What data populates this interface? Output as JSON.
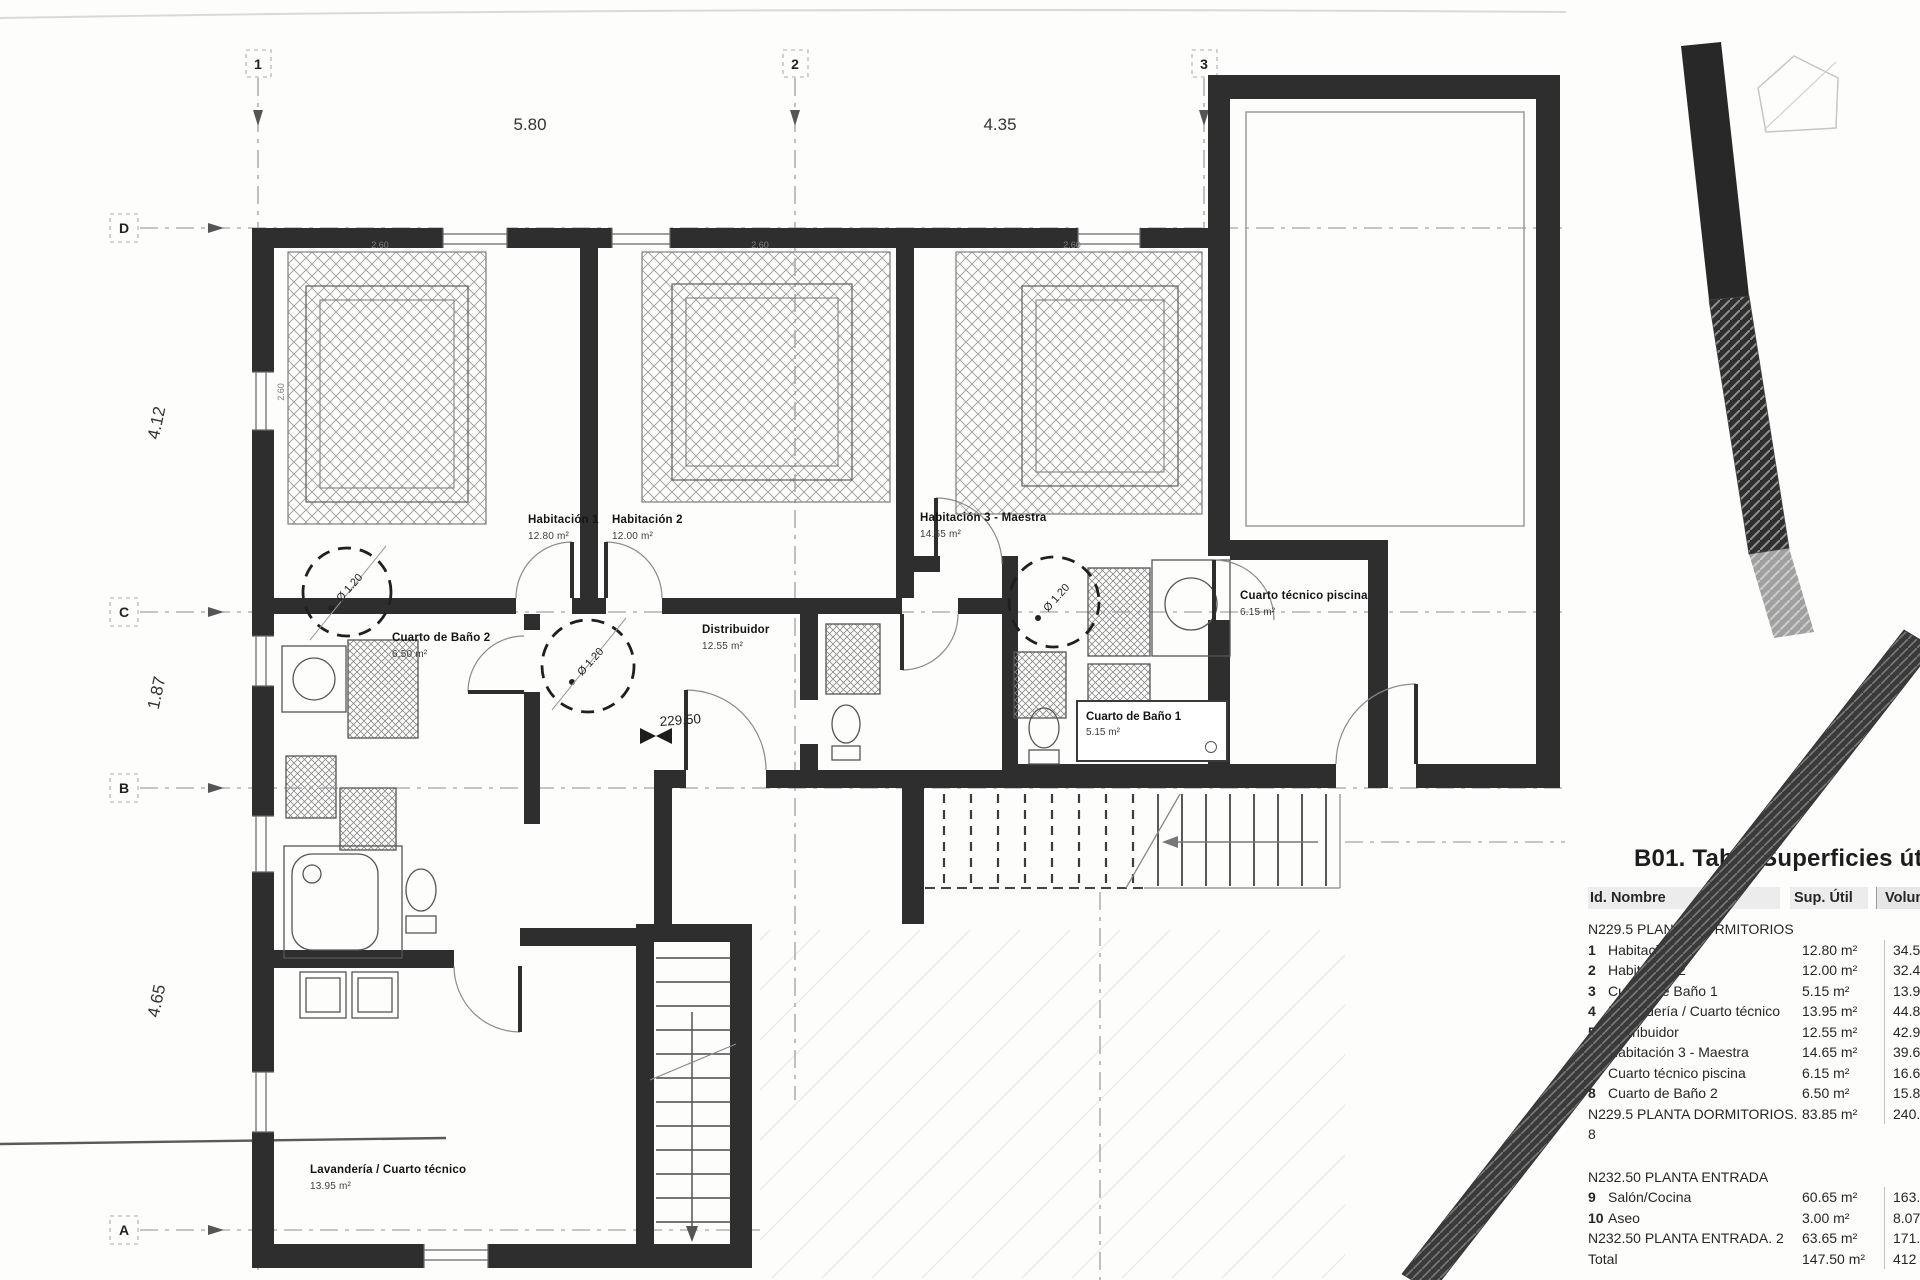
{
  "dimensions": {
    "top": [
      "5.80",
      "4.35"
    ],
    "left": [
      "4.12",
      "1.87",
      "4.65"
    ]
  },
  "grid": {
    "columns": [
      "1",
      "2",
      "3"
    ],
    "rows": [
      "D",
      "C",
      "B",
      "A"
    ]
  },
  "annotations": {
    "level": "229.50",
    "turning_circle": "Ø 1.20",
    "bed_dim": "2.60"
  },
  "rooms": {
    "hab1": {
      "name": "Habitación 1",
      "area": "12.80 m²"
    },
    "hab2": {
      "name": "Habitación 2",
      "area": "12.00 m²"
    },
    "hab3": {
      "name": "Habitación 3 - Maestra",
      "area": "14.65 m²"
    },
    "bano2": {
      "name": "Cuarto de Baño 2",
      "area": "6.50 m²"
    },
    "distribuidor": {
      "name": "Distribuidor",
      "area": "12.55 m²"
    },
    "piscina": {
      "name": "Cuarto técnico piscina",
      "area": "6.15 m²"
    },
    "bano1": {
      "name": "Cuarto de Baño 1",
      "area": "5.15 m²"
    },
    "lavanderia": {
      "name": "Lavandería / Cuarto técnico",
      "area": "13.95 m²"
    }
  },
  "table": {
    "title": "B01. Tabla Superficies útiles",
    "headers": {
      "id": "Id.",
      "nombre": "Nombre",
      "sup": "Sup. Útil",
      "vol": "Volumen"
    },
    "rows": [
      {
        "kind": "section",
        "name": "N229.5 PLANTA DORMITORIOS"
      },
      {
        "kind": "item",
        "id": "1",
        "name": "Habitación 1",
        "sup": "12.80 m²",
        "vol": "34.57 m³"
      },
      {
        "kind": "item",
        "id": "2",
        "name": "Habitación 2",
        "sup": "12.00 m²",
        "vol": "32.47 m³"
      },
      {
        "kind": "item",
        "id": "3",
        "name": "Cuarto de Baño 1",
        "sup": "5.15 m²",
        "vol": "13.96 m³"
      },
      {
        "kind": "item",
        "id": "4",
        "name": "Lavandería / Cuarto técnico",
        "sup": "13.95 m²",
        "vol": "44.81 m³"
      },
      {
        "kind": "item",
        "id": "5",
        "name": "Distribuidor",
        "sup": "12.55 m²",
        "vol": "42.92 m³"
      },
      {
        "kind": "item",
        "id": "6",
        "name": "Habitación 3 - Maestra",
        "sup": "14.65 m²",
        "vol": "39.60 m³"
      },
      {
        "kind": "item",
        "id": "7",
        "name": "Cuarto técnico piscina",
        "sup": "6.15 m²",
        "vol": "16.60 m³"
      },
      {
        "kind": "item",
        "id": "8",
        "name": "Cuarto de Baño 2",
        "sup": "6.50 m²",
        "vol": "15.89 m³"
      },
      {
        "kind": "subtotal",
        "name": "N229.5 PLANTA DORMITORIOS",
        "count": "8",
        "sup": "83.85 m²",
        "vol": "240.82 m³"
      },
      {
        "kind": "section gap",
        "name": "N232.50 PLANTA ENTRADA"
      },
      {
        "kind": "item",
        "id": "9",
        "name": "Salón/Cocina",
        "sup": "60.65 m²",
        "vol": "163.7 m³"
      },
      {
        "kind": "item",
        "id": "10",
        "name": "Aseo",
        "sup": "3.00 m²",
        "vol": "8.07 m³"
      },
      {
        "kind": "subtotal",
        "name": "N232.50 PLANTA ENTRADA",
        "count": "2",
        "sup": "63.65 m²",
        "vol": "171.7 m³"
      },
      {
        "kind": "total",
        "name": "Total",
        "sup": "147.50 m²",
        "vol": "412 m³"
      }
    ]
  }
}
